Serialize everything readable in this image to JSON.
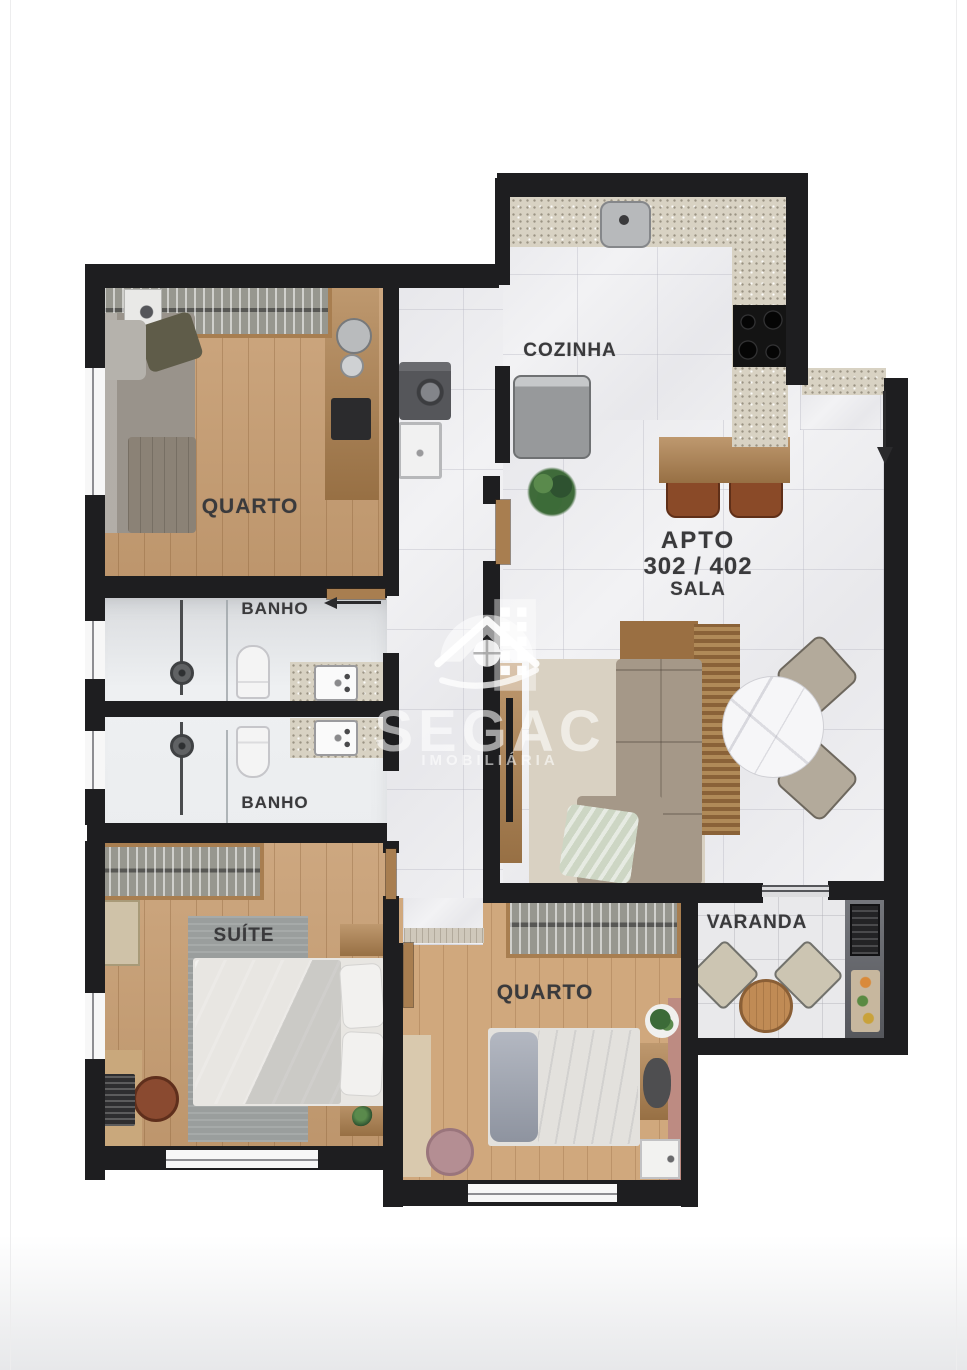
{
  "plan": {
    "apartment": {
      "building_label": "APTO",
      "unit_numbers": "302 / 402",
      "room": "SALA"
    },
    "rooms": {
      "cozinha": {
        "label": "COZINHA"
      },
      "quarto1": {
        "label": "QUARTO"
      },
      "banho1": {
        "label": "BANHO"
      },
      "banho2": {
        "label": "BANHO"
      },
      "suite": {
        "label": "SUÍTE"
      },
      "quarto2": {
        "label": "QUARTO"
      },
      "varanda": {
        "label": "VARANDA"
      }
    }
  },
  "watermark": {
    "brand": "SEGAC",
    "tagline": "IMOBILIÁRIA"
  },
  "colors": {
    "wall": "#1e1e20",
    "wood_floor": "#c89e72",
    "granite_counter": "#d8d2c3",
    "accent_wall": "#bd8b82",
    "label_text": "#3a3a3c",
    "watermark": "rgba(255,255,255,0.58)"
  }
}
